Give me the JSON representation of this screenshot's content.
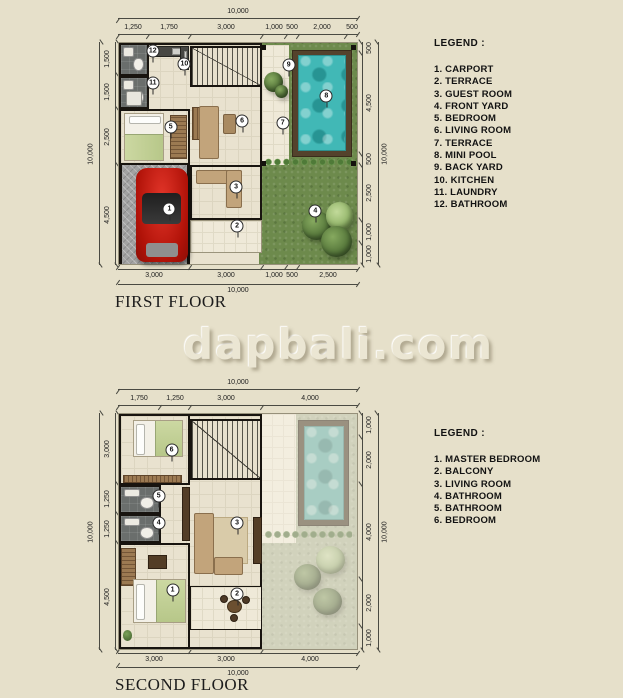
{
  "watermark": "dapbali.com",
  "first_floor": {
    "name": "FIRST FLOOR",
    "total": "10,000",
    "dims_top": [
      "1,250",
      "1,750",
      "3,000",
      "1,000",
      "500",
      "2,000",
      "500"
    ],
    "dims_bottom": [
      "3,000",
      "3,000",
      "1,000",
      "500",
      "2,500"
    ],
    "dims_left": [
      "1,500",
      "1,500",
      "2,500",
      "4,500"
    ],
    "dims_right": [
      "500",
      "4,500",
      "500",
      "2,500",
      "1,000",
      "1,000"
    ],
    "legend_title": "LEGEND :",
    "legend_items": [
      "1. CARPORT",
      "2. TERRACE",
      "3. GUEST ROOM",
      "4. FRONT YARD",
      "5. BEDROOM",
      "6. LIVING ROOM",
      "7. TERRACE",
      "8. MINI POOL",
      "9. BACK YARD",
      "10. KITCHEN",
      "11. LAUNDRY",
      "12. BATHROOM"
    ],
    "badges": [
      {
        "n": "1",
        "x": 21.2,
        "y": 75.3
      },
      {
        "n": "2",
        "x": 49.6,
        "y": 83.0
      },
      {
        "n": "3",
        "x": 49.2,
        "y": 65.0
      },
      {
        "n": "4",
        "x": 82.5,
        "y": 75.8
      },
      {
        "n": "5",
        "x": 21.7,
        "y": 38.1
      },
      {
        "n": "6",
        "x": 51.7,
        "y": 35.4
      },
      {
        "n": "7",
        "x": 68.8,
        "y": 36.3
      },
      {
        "n": "8",
        "x": 87.1,
        "y": 23.8
      },
      {
        "n": "9",
        "x": 71.3,
        "y": 9.9
      },
      {
        "n": "10",
        "x": 27.5,
        "y": 9.4
      },
      {
        "n": "11",
        "x": 14.2,
        "y": 17.9
      },
      {
        "n": "12",
        "x": 14.2,
        "y": 3.6
      }
    ]
  },
  "second_floor": {
    "name": "SECOND FLOOR",
    "total": "10,000",
    "dims_top": [
      "1,750",
      "1,250",
      "3,000",
      "4,000"
    ],
    "dims_bottom": [
      "3,000",
      "3,000",
      "4,000"
    ],
    "dims_left": [
      "3,000",
      "1,250",
      "1,250",
      "4,500"
    ],
    "dims_right": [
      "1,000",
      "2,000",
      "4,000",
      "2,000",
      "1,000"
    ],
    "legend_title": "LEGEND :",
    "legend_items": [
      "1. MASTER BEDROOM",
      "2. BALCONY",
      "3. LIVING ROOM",
      "4. BATHROOM",
      "5. BATHROOM",
      "6. BEDROOM"
    ],
    "badges": [
      {
        "n": "1",
        "x": 22.5,
        "y": 75.1
      },
      {
        "n": "2",
        "x": 49.6,
        "y": 76.4
      },
      {
        "n": "3",
        "x": 49.6,
        "y": 46.4
      },
      {
        "n": "4",
        "x": 16.7,
        "y": 46.4
      },
      {
        "n": "5",
        "x": 16.7,
        "y": 35.0
      },
      {
        "n": "6",
        "x": 22.1,
        "y": 15.2
      }
    ]
  },
  "colors": {
    "background": "#e6e0ca",
    "grass": "#6d8a4c",
    "pool_water": "#41b8b6",
    "pool_deck": "#54422c",
    "wall": "#18140f",
    "floor_tile": "#eae3d0",
    "bath_floor": "#6a6e6c",
    "carport": "#a2a2a2",
    "car": "#b01208"
  }
}
